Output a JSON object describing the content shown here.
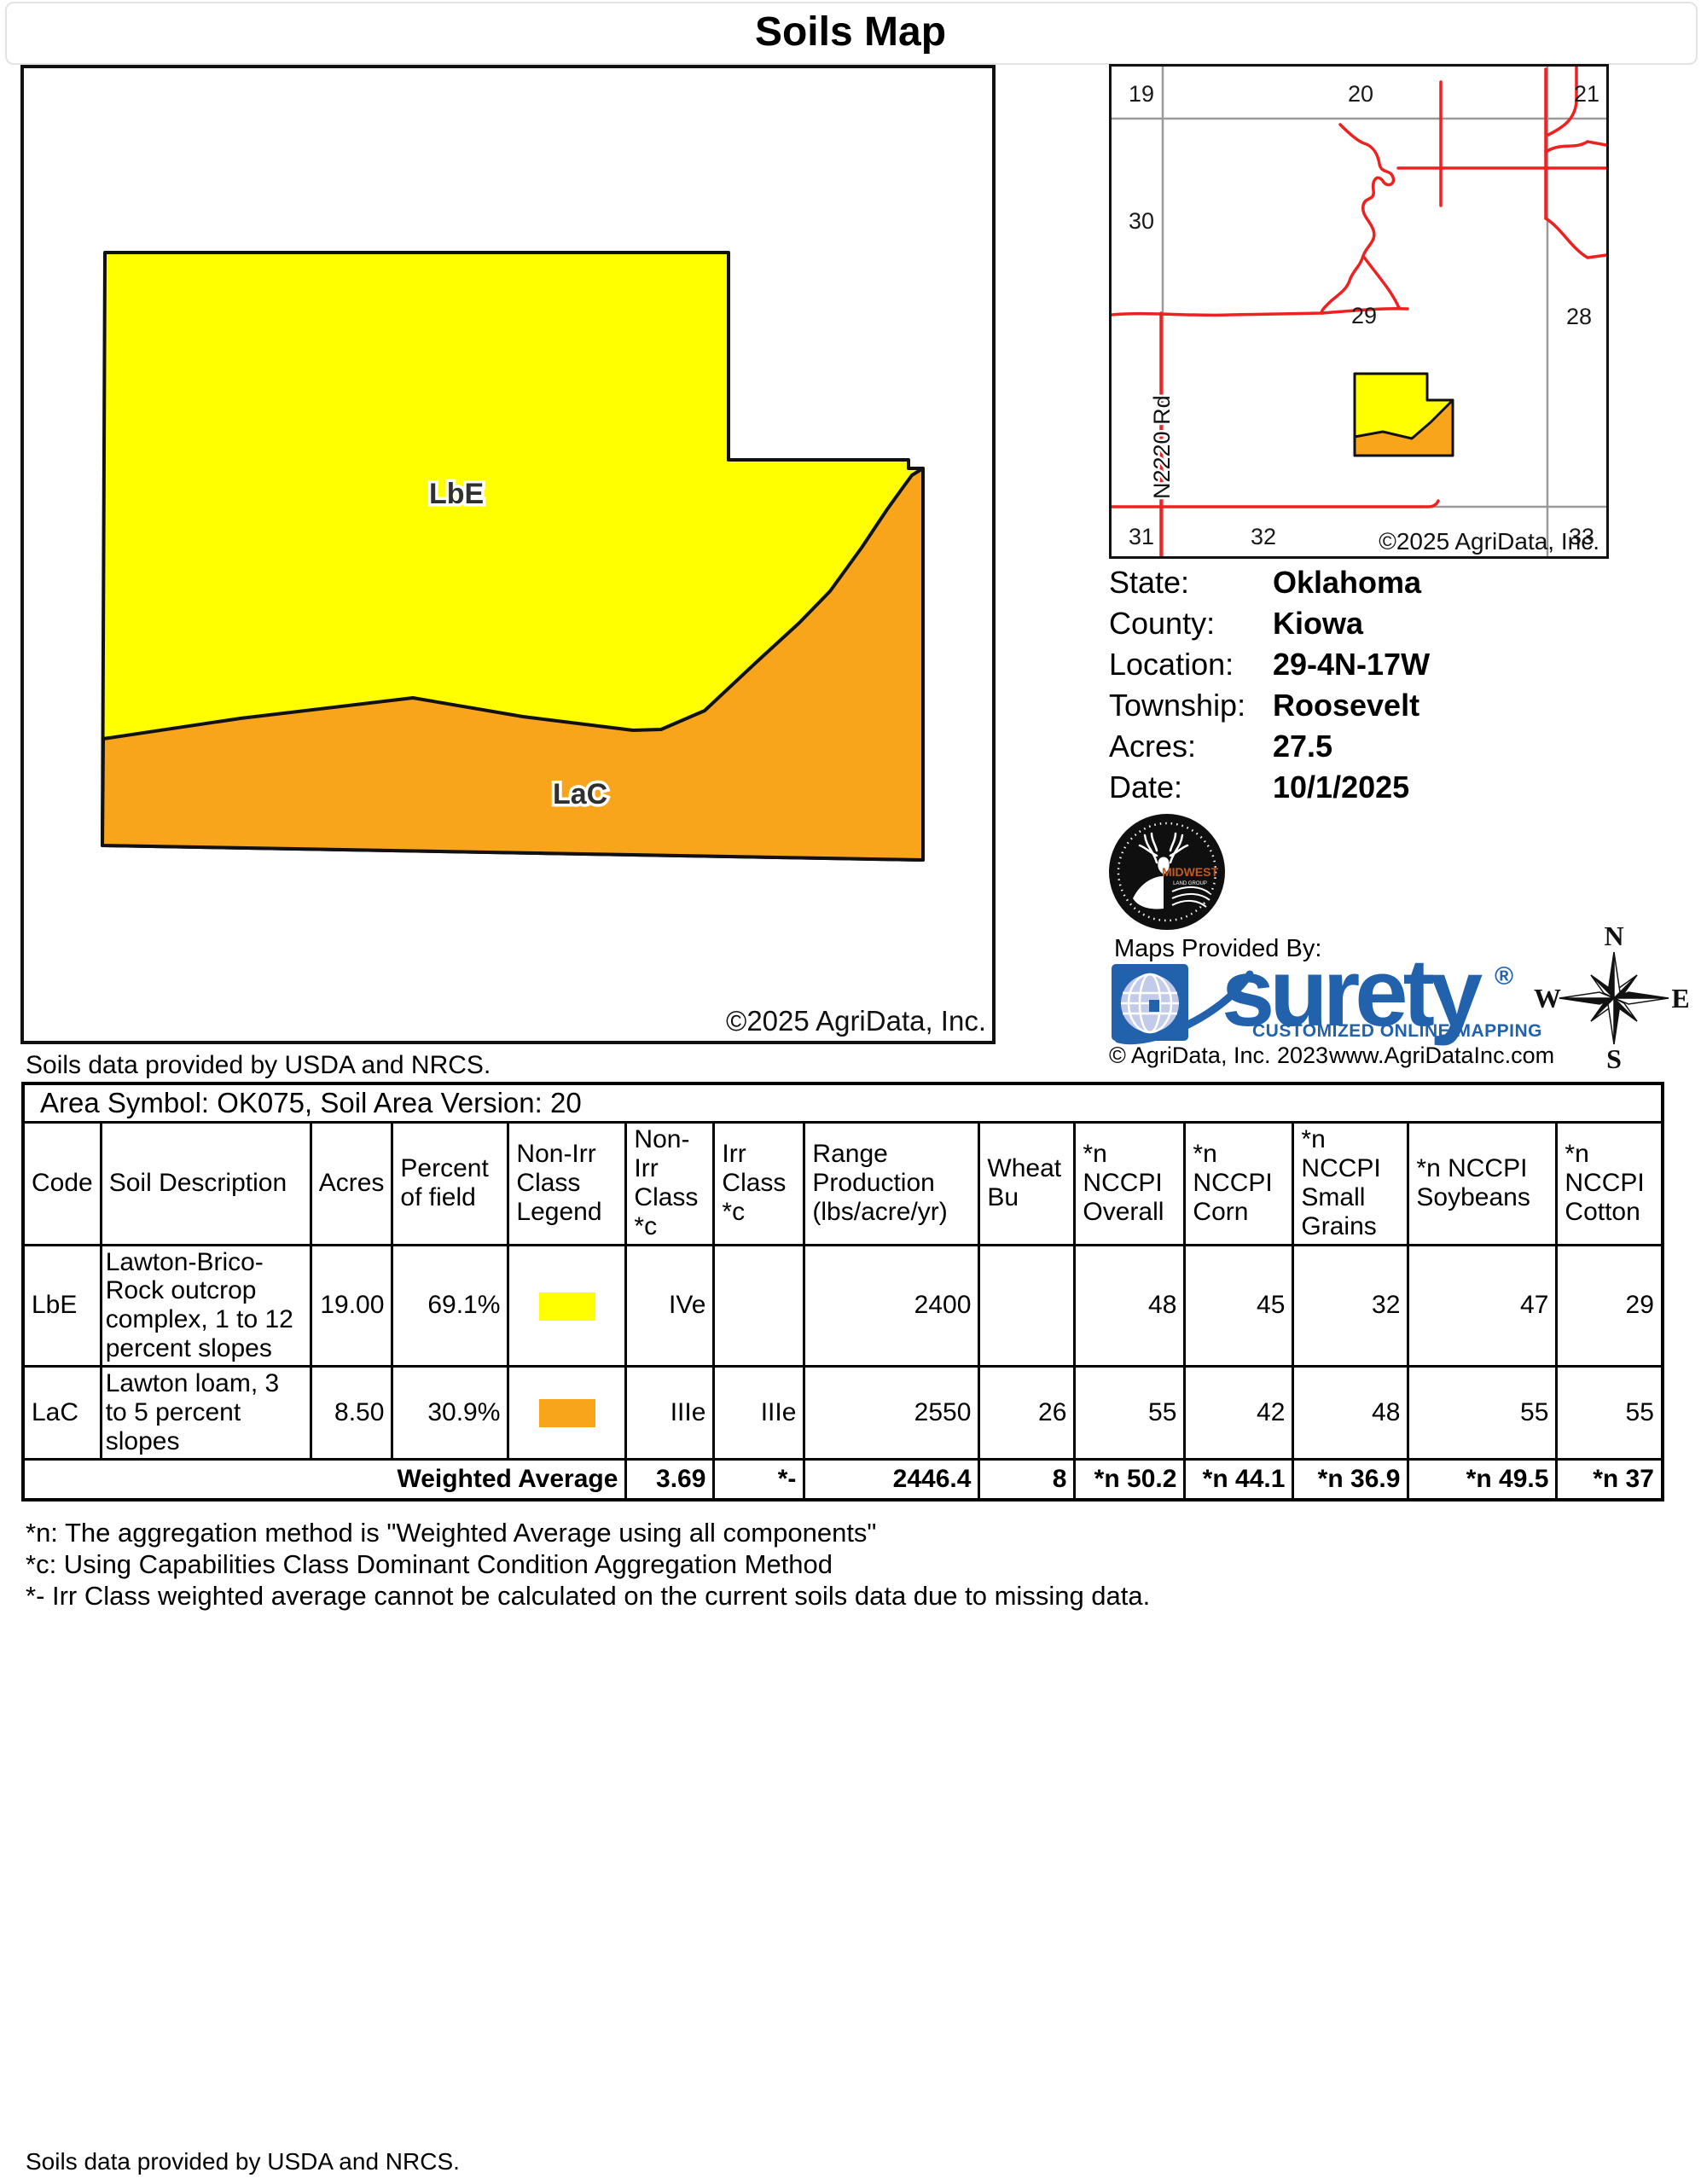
{
  "page": {
    "title": "Soils Map",
    "footer": "Soils data provided by USDA and NRCS."
  },
  "map": {
    "region_labels": {
      "lbe": "LbE",
      "lac": "LaC"
    },
    "copyright": "©2025 AgriData, Inc.",
    "attribution": "Soils data provided by USDA and NRCS."
  },
  "inset": {
    "sections": [
      "19",
      "20",
      "21",
      "30",
      "29",
      "28",
      "31",
      "32",
      "33"
    ],
    "road_label": "N2220 Rd",
    "copyright": "©2025 AgriData, Inc."
  },
  "info": {
    "rows": [
      {
        "label": "State:",
        "value": "Oklahoma"
      },
      {
        "label": "County:",
        "value": "Kiowa"
      },
      {
        "label": "Location:",
        "value": "29-4N-17W"
      },
      {
        "label": "Township:",
        "value": "Roosevelt"
      },
      {
        "label": "Acres:",
        "value": "27.5"
      },
      {
        "label": "Date:",
        "value": "10/1/2025"
      }
    ]
  },
  "branding": {
    "midwest_name": "MIDWEST",
    "midwest_sub": "LAND GROUP",
    "maps_provided_by": "Maps Provided By:",
    "surety_wordmark": "surety",
    "surety_reg": "®",
    "surety_tagline": "CUSTOMIZED ONLINE MAPPING",
    "agridata_copyright": "© AgriData, Inc. 2023",
    "agridata_url": "www.AgriDataInc.com"
  },
  "compass": {
    "n": "N",
    "s": "S",
    "e": "E",
    "w": "W"
  },
  "table": {
    "area_title": "Area Symbol: OK075, Soil Area Version: 20",
    "columns": [
      "Code",
      "Soil Description",
      "Acres",
      "Percent of field",
      "Non-Irr Class Legend",
      "Non-Irr Class *c",
      "Irr Class *c",
      "Range Production (lbs/acre/yr)",
      "Wheat Bu",
      "*n NCCPI Overall",
      "*n NCCPI Corn",
      "*n NCCPI Small Grains",
      "*n NCCPI Soybeans",
      "*n NCCPI Cotton"
    ],
    "rows": [
      {
        "code": "LbE",
        "description": "Lawton-Brico-Rock outcrop complex, 1 to 12 percent slopes",
        "acres": "19.00",
        "percent": "69.1%",
        "legend_color": "#FFFF00",
        "non_irr_class": "IVe",
        "irr_class": "",
        "range_production": "2400",
        "wheat_bu": "",
        "nccpi_overall": "48",
        "nccpi_corn": "45",
        "nccpi_small_grains": "32",
        "nccpi_soybeans": "47",
        "nccpi_cotton": "29"
      },
      {
        "code": "LaC",
        "description": "Lawton loam, 3 to 5 percent slopes",
        "acres": "8.50",
        "percent": "30.9%",
        "legend_color": "#F9A51B",
        "non_irr_class": "IIIe",
        "irr_class": "IIIe",
        "range_production": "2550",
        "wheat_bu": "26",
        "nccpi_overall": "55",
        "nccpi_corn": "42",
        "nccpi_small_grains": "48",
        "nccpi_soybeans": "55",
        "nccpi_cotton": "55"
      }
    ],
    "weighted": {
      "label": "Weighted Average",
      "non_irr_class": "3.69",
      "irr_class": "*-",
      "range_production": "2446.4",
      "wheat_bu": "8",
      "nccpi_overall": "*n 50.2",
      "nccpi_corn": "*n 44.1",
      "nccpi_small_grains": "*n 36.9",
      "nccpi_soybeans": "*n 49.5",
      "nccpi_cotton": "*n 37"
    }
  },
  "footnotes": [
    "*n: The aggregation method is \"Weighted Average using all components\"",
    "*c: Using Capabilities Class Dominant Condition Aggregation Method",
    "*- Irr Class weighted average cannot be calculated on the current soils data due to missing data."
  ],
  "colors": {
    "soil_yellow": "#FFFF00",
    "soil_orange": "#F9A51B",
    "surety_blue": "#2261AC",
    "road_red": "#EE2020",
    "grid_gray": "#9a9a9a"
  }
}
